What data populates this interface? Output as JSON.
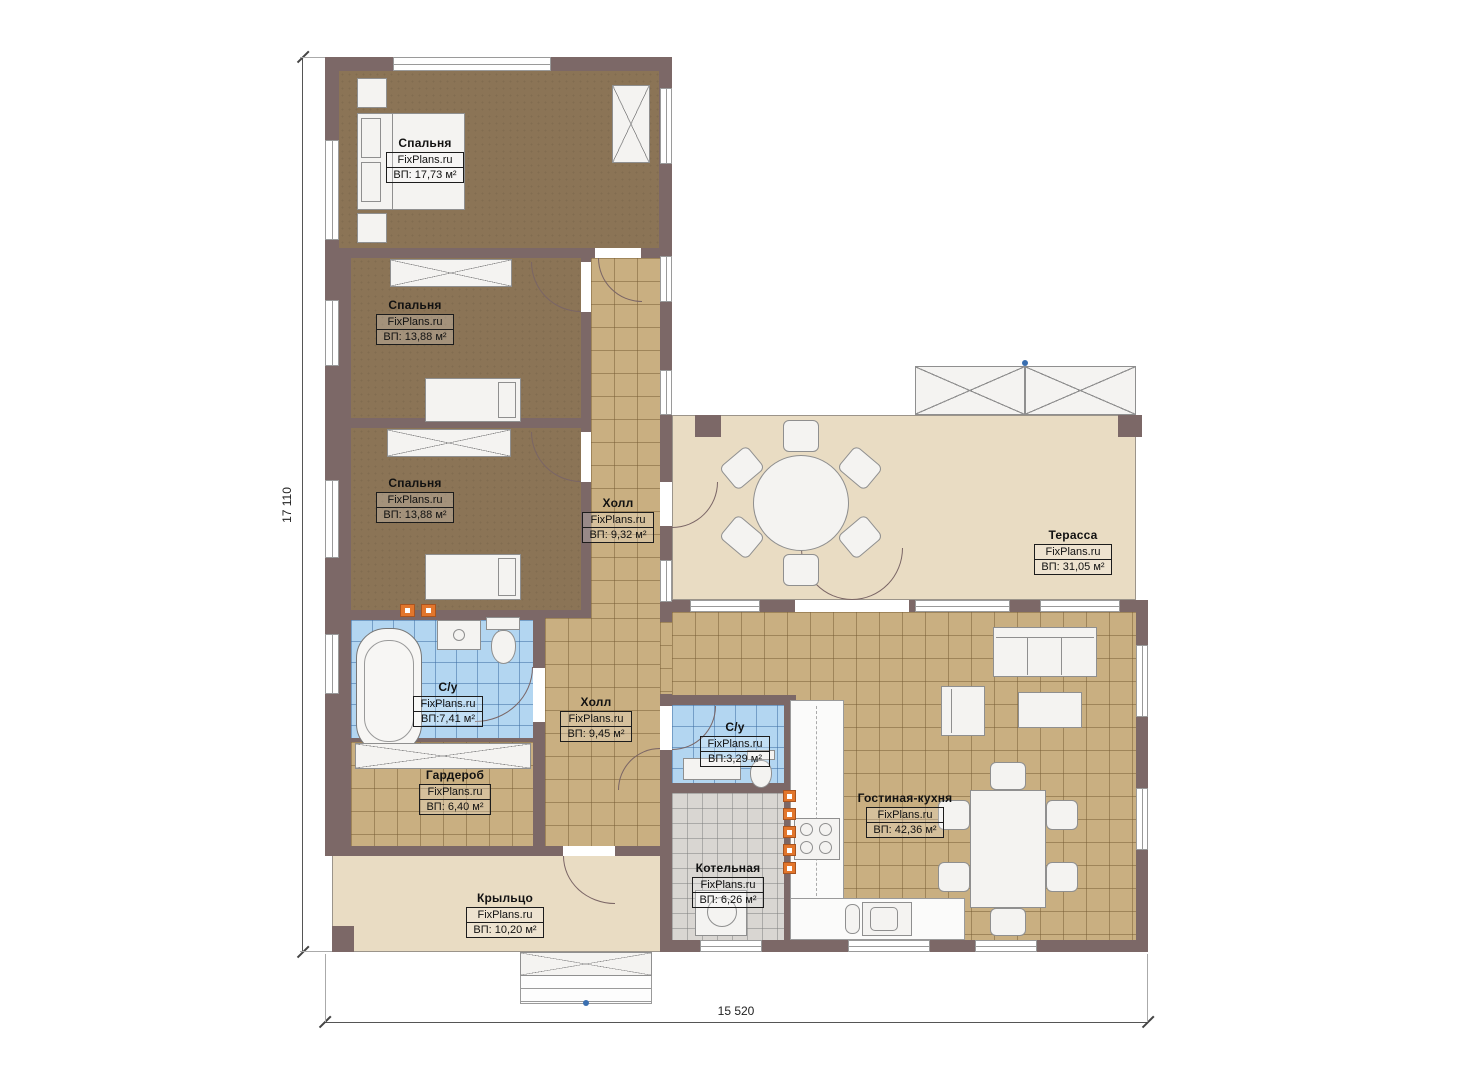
{
  "plan": {
    "brand": "FixPlans.ru",
    "rooms": [
      {
        "name": "Спальня",
        "area": "ВП: 17,73 м²"
      },
      {
        "name": "Спальня",
        "area": "ВП: 13,88 м²"
      },
      {
        "name": "Спальня",
        "area": "ВП: 13,88 м²"
      },
      {
        "name": "Холл",
        "area": "ВП: 9,32 м²"
      },
      {
        "name": "Терасса",
        "area": "ВП: 31,05 м²"
      },
      {
        "name": "С/у",
        "area": "ВП:7,41 м²"
      },
      {
        "name": "Холл",
        "area": "ВП: 9,45 м²"
      },
      {
        "name": "С/у",
        "area": "ВП:3,29 м²"
      },
      {
        "name": "Гардероб",
        "area": "ВП: 6,40 м²"
      },
      {
        "name": "Гостиная-кухня",
        "area": "ВП: 42,36 м²"
      },
      {
        "name": "Котельная",
        "area": "ВП: 6,26 м²"
      },
      {
        "name": "Крыльцо",
        "area": "ВП: 10,20 м²"
      }
    ],
    "dimensions": {
      "height": "17 110",
      "width": "15 520"
    },
    "icons": {
      "stove": "✳"
    },
    "colors": {
      "wall": "#7c6867",
      "bedroom_floor": "#8b7456",
      "tile_floor": "#c9af81",
      "bath_tile": "#b3d6f1",
      "boiler_tile": "#d9d6d2",
      "terrace_floor": "#e9dcc3",
      "radiator_orange": "#e2762c",
      "marker_blue": "#3a6fb0"
    }
  }
}
